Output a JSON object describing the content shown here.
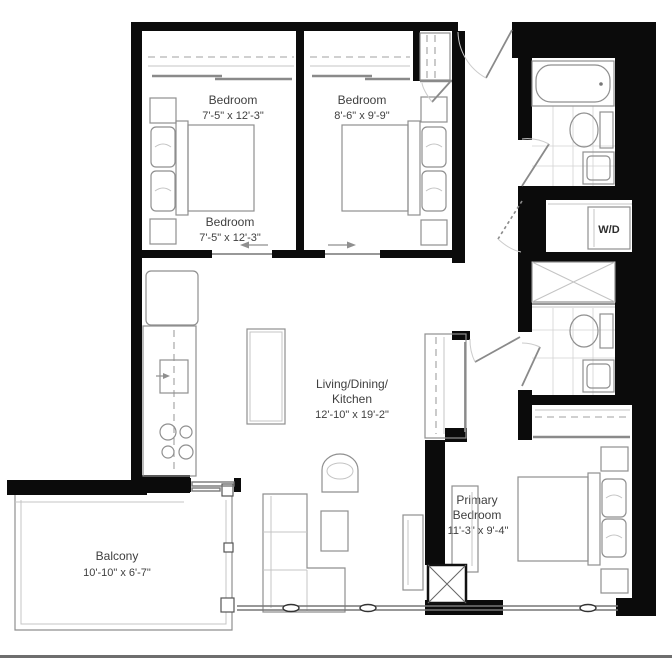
{
  "page": {
    "background": "#ffffff",
    "type": "apartment-floor-plan"
  },
  "colors": {
    "wall": "#0b0b0b",
    "fixture_line": "#8f8f8f",
    "light_line": "#c4c4c4",
    "text": "#3f3f3f",
    "divider": "#6e6e6e"
  },
  "rooms": {
    "bedroom1": {
      "label_top": {
        "name": "Bedroom",
        "dims": "7'-5\" x 12'-3\""
      },
      "label_bottom": {
        "name": "Bedroom",
        "dims": "7'-5\" x 12'-3\""
      }
    },
    "bedroom2": {
      "label": {
        "name": "Bedroom",
        "dims": "8'-6\" x 9'-9\""
      }
    },
    "living": {
      "label": {
        "line1": "Living/Dining/",
        "line2": "Kitchen",
        "dims": "12'-10\" x 19'-2\""
      }
    },
    "primary": {
      "label": {
        "line1": "Primary",
        "line2": "Bedroom",
        "dims": "11'-3\" x 9'-4\""
      }
    },
    "balcony": {
      "label": {
        "name": "Balcony",
        "dims": "10'-10\" x 6'-7\""
      }
    },
    "laundry": {
      "label": "W/D"
    }
  }
}
